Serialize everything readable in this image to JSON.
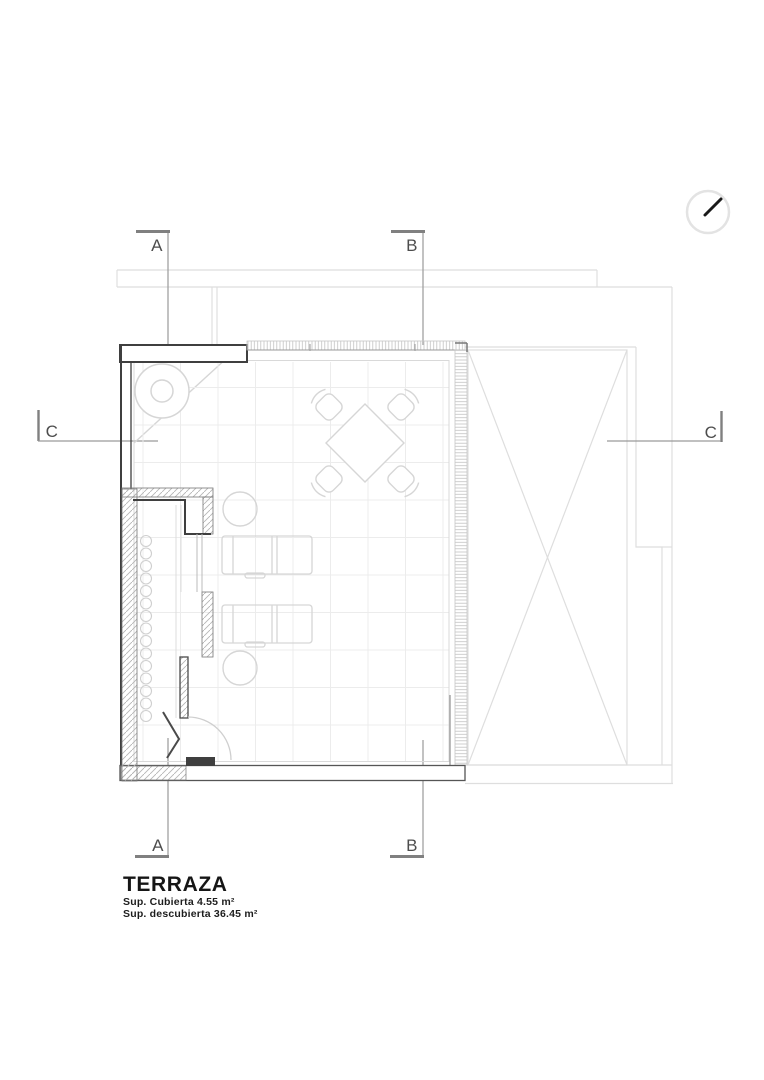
{
  "document": {
    "type": "architectural floor plan",
    "title": "TERRAZA",
    "area_covered": "Sup. Cubierta 4.55 m²",
    "area_uncovered": "Sup. descubierta 36.45 m²"
  },
  "markers": {
    "section_a_top": "A",
    "section_b_top": "B",
    "section_c_left": "C",
    "section_c_right": "C",
    "section_a_bottom": "A",
    "section_b_bottom": "B"
  },
  "icons": {
    "north_arrow": "north-arrow-icon"
  },
  "colors": {
    "wall_dark": "#3f3f3f",
    "section_line": "#9a9a9a",
    "drawing_light": "#d6d6d6",
    "grid": "#ececec",
    "background_context": "#dedede",
    "hatch": "#b5b5b5",
    "marker_text": "#4d4d4d",
    "title_text": "#161616"
  }
}
